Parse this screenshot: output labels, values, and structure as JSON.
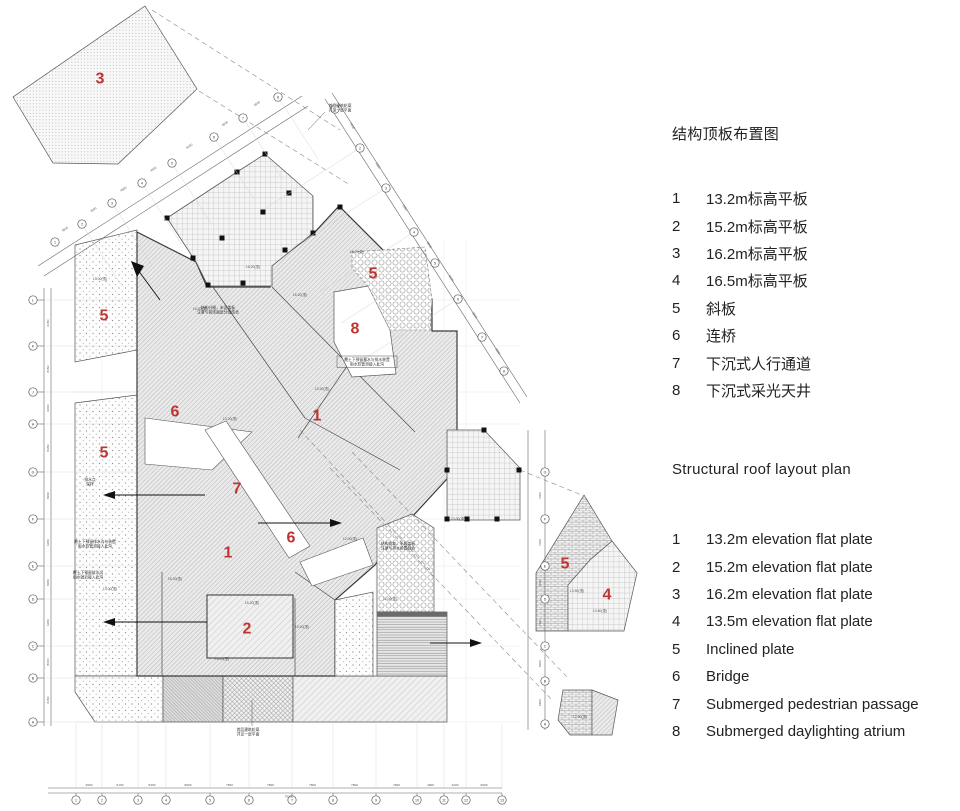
{
  "legend_zh": {
    "title": "结构顶板布置图",
    "items": [
      {
        "num": "1",
        "label": "13.2m标高平板"
      },
      {
        "num": "2",
        "label": "15.2m标高平板"
      },
      {
        "num": "3",
        "label": "16.2m标高平板"
      },
      {
        "num": "4",
        "label": "16.5m标高平板"
      },
      {
        "num": "5",
        "label": "斜板"
      },
      {
        "num": "6",
        "label": "连桥"
      },
      {
        "num": "7",
        "label": "下沉式人行通道"
      },
      {
        "num": "8",
        "label": "下沉式采光天井"
      }
    ]
  },
  "legend_en": {
    "title": "Structural roof layout plan",
    "items": [
      {
        "num": "1",
        "label": "13.2m elevation flat plate"
      },
      {
        "num": "2",
        "label": "15.2m elevation flat plate"
      },
      {
        "num": "3",
        "label": "16.2m elevation flat plate"
      },
      {
        "num": "4",
        "label": "13.5m elevation flat plate"
      },
      {
        "num": "5",
        "label": "Inclined plate"
      },
      {
        "num": "6",
        "label": "Bridge"
      },
      {
        "num": "7",
        "label": "Submerged pedestrian passage"
      },
      {
        "num": "8",
        "label": "Submerged daylighting atrium"
      }
    ]
  },
  "plan": {
    "region_labels": [
      "3",
      "5",
      "5",
      "6",
      "1",
      "8",
      "5",
      "7",
      "1",
      "6",
      "2",
      "5",
      "4"
    ],
    "axes": {
      "left": [
        "L",
        "K",
        "J",
        "H",
        "G",
        "F",
        "E",
        "D",
        "C",
        "B",
        "A"
      ],
      "right": [
        "G",
        "F",
        "E",
        "D",
        "C",
        "B",
        "A"
      ],
      "bottom": [
        "1",
        "2",
        "3",
        "4",
        "5",
        "6",
        "7",
        "8",
        "9",
        "10",
        "11",
        "12",
        "13"
      ],
      "diag_upper_left": [
        "1",
        "2",
        "3",
        "4",
        "5",
        "6",
        "7",
        "8"
      ],
      "diag_upper_right": [
        "1",
        "2",
        "3",
        "4",
        "5",
        "6",
        "7",
        "8"
      ]
    },
    "dims": {
      "bottom": [
        "4500",
        "6100",
        "5300",
        "8000",
        "7500",
        "7800",
        "7800",
        "7800",
        "7800",
        "4900",
        "4200",
        "6600"
      ],
      "bottom_overall": "75200",
      "left": [
        "6150",
        "8150",
        "6200",
        "8150",
        "8150",
        "6150",
        "8150",
        "6150",
        "8000",
        "6150"
      ],
      "right": [
        "7000",
        "7000",
        "5000",
        "7000",
        "5200",
        "6500"
      ],
      "diag_left": [
        "4500",
        "4500",
        "4500",
        "4500",
        "6000",
        "4500",
        "4500"
      ],
      "diag_right": [
        "7000",
        "7000",
        "7400",
        "5000",
        "6000",
        "6500",
        "5800"
      ]
    },
    "annotations": [
      {
        "l1": "首层建筑轮廓",
        "l2": "详见一层平面"
      },
      {
        "l1": "首层建筑轮廓",
        "l2": "详见一层平面"
      },
      {
        "l1": "结构分缝，未设盖板",
        "l2": "注意与装饰面层分缝结合"
      },
      {
        "l1": "覆土下预留蓄水与排水装置",
        "l2": "雨水软管须接入此沟"
      },
      {
        "l1": "覆土下预留排水沟",
        "l2": "雨水就近接入此沟"
      },
      {
        "l1": "排水点",
        "l2": "采样"
      },
      {
        "l1": "覆土下预留排水沟与装置",
        "l2": "雨水软管须接入此沟"
      },
      {
        "l1": "结构找坡，不设盖板",
        "l2": "注意与排水装置结合"
      }
    ],
    "elevations": [
      "16.20(顶)",
      "15.20(顶)",
      "13.20(顶)",
      "13.20(顶)",
      "15.20(顶)",
      "15.20(顶)",
      "13.20(顶)",
      "13.20(顶)",
      "12.00(顶)",
      "11.00(顶)",
      "13.50(顶)",
      "13.50(顶)",
      "12.00(顶)",
      "16.20(坡)",
      "13.00(顶)",
      "13.00(顶)",
      "13.00(顶)",
      "15.20(顶)"
    ]
  },
  "colors": {
    "label_red": "#bd3431",
    "line_dark": "#3a3a3a",
    "line_mid": "#555555"
  }
}
